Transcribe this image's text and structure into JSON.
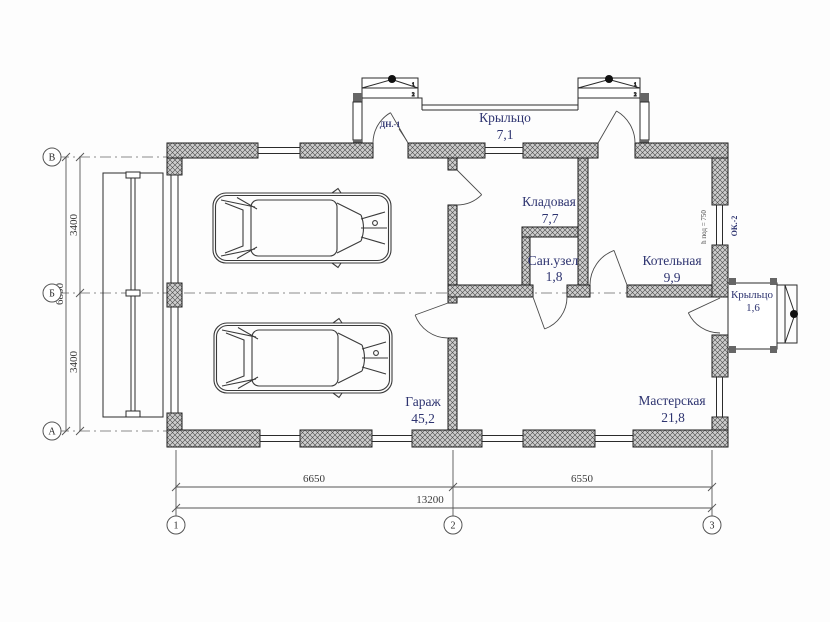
{
  "plan": {
    "rooms": [
      {
        "name": "Крыльцо",
        "area": "7,1"
      },
      {
        "name": "Кладовая",
        "area": "7,7"
      },
      {
        "name": "Сан.узел",
        "area": "1,8"
      },
      {
        "name": "Котельная",
        "area": "9,9"
      },
      {
        "name": "Крыльцо",
        "area": "1,6"
      },
      {
        "name": "Гараж",
        "area": "45,2"
      },
      {
        "name": "Мастерская",
        "area": "21,8"
      }
    ],
    "tags": {
      "door": "ДН.-1",
      "window": "ОК.-2",
      "window_sill_note": "h под = 750"
    },
    "axes": {
      "rows": [
        "В",
        "Б",
        "А"
      ],
      "cols": [
        "1",
        "2",
        "3"
      ]
    },
    "dimensions": {
      "left_spans": [
        "3400",
        "3400"
      ],
      "left_total": "6800",
      "bottom_spans": [
        "6650",
        "6550"
      ],
      "bottom_total": "13200"
    },
    "steps": [
      "1",
      "2"
    ],
    "colors": {
      "label": "#2e3470",
      "line": "#2b2b2b",
      "hatch_fill": "#cdcdcd",
      "hatch_line": "#4a4a4a"
    }
  }
}
